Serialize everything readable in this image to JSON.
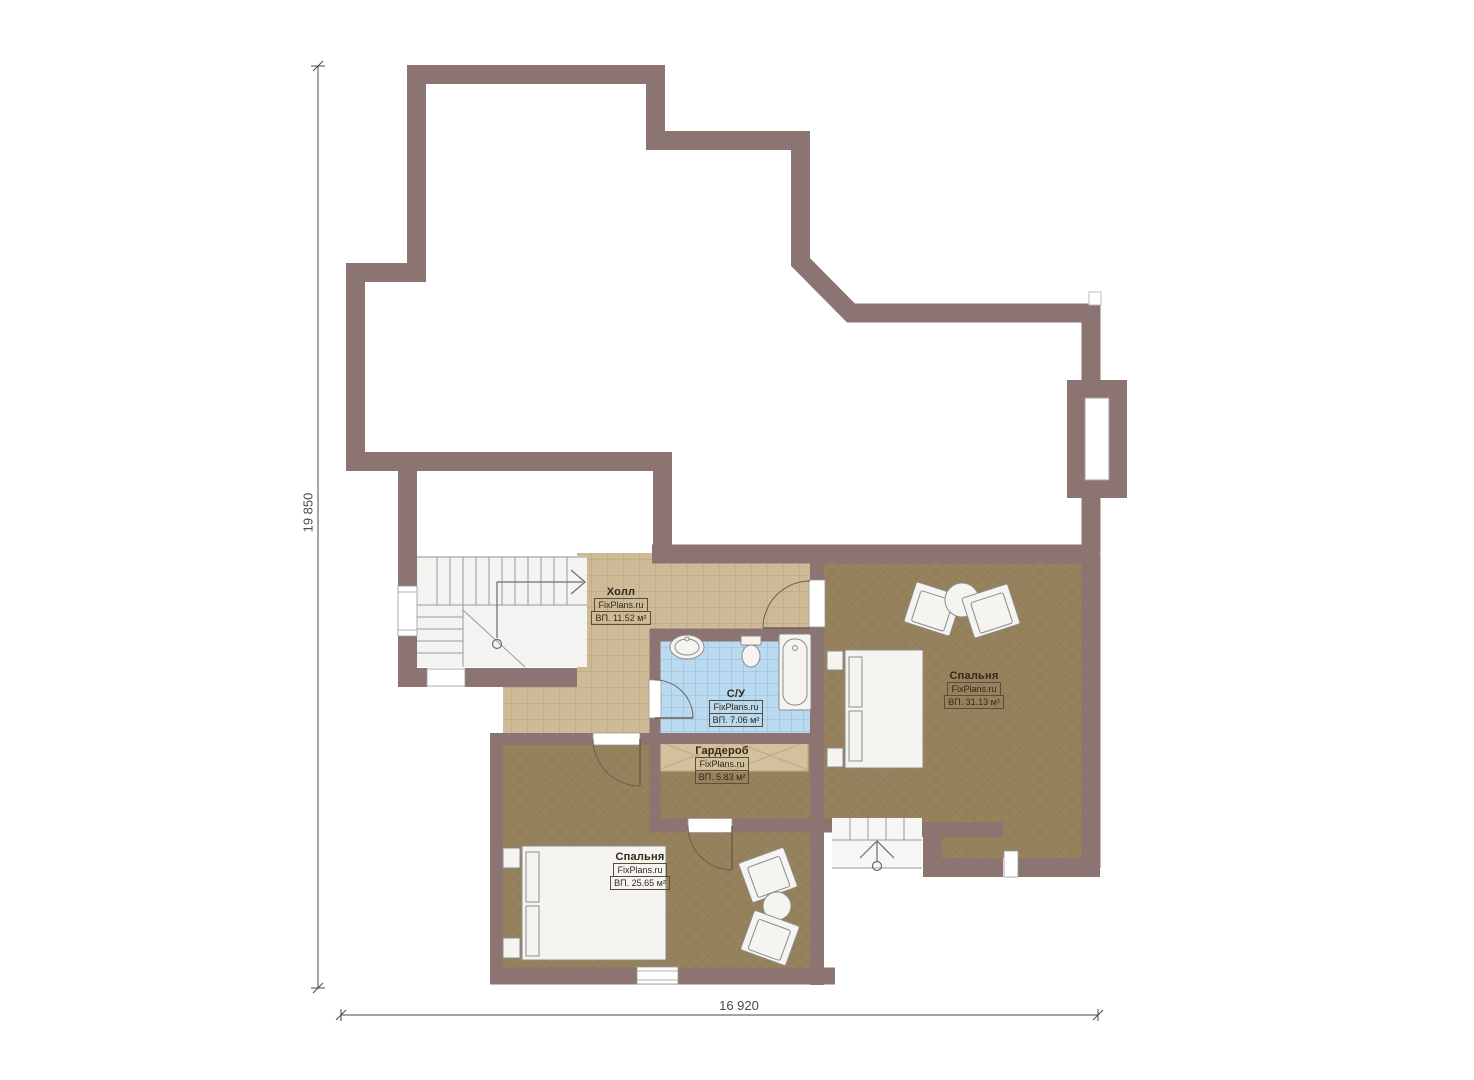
{
  "plan": {
    "title": "Floor plan (second floor)",
    "dimensions": {
      "left_total": "19 850",
      "bottom_total": "16 920"
    },
    "rooms": [
      {
        "id": "hall",
        "name": "Холл",
        "watermark": "FixPlans.ru",
        "area": "ВП. 11.52 м²"
      },
      {
        "id": "bathroom",
        "name": "С/У",
        "watermark": "FixPlans.ru",
        "area": "ВП. 7.06 м²"
      },
      {
        "id": "wardrobe",
        "name": "Гардероб",
        "watermark": "FixPlans.ru",
        "area": "ВП. 5.83 м²"
      },
      {
        "id": "bedroom-right",
        "name": "Спальня",
        "watermark": "FixPlans.ru",
        "area": "ВП. 31.13 м²"
      },
      {
        "id": "bedroom-left",
        "name": "Спальня",
        "watermark": "FixPlans.ru",
        "area": "ВП. 25.65 м²"
      }
    ],
    "colors": {
      "wall": "#8b7472",
      "hallTile": "#cdbb97",
      "hallGrid": "#b3a079",
      "bathTile": "#badaef",
      "bathGrid": "#93bcd8",
      "wardTile": "#d3c19d",
      "wardGrid": "#bcab85",
      "floorBrown": "#97825e",
      "floorLine": "#7d6a48",
      "stairBg": "#f3f3f1",
      "stairLine": "#9a9a9a",
      "furnFill": "#f5f4f1",
      "furnStroke": "#8b8b8b",
      "doorArc": "#6f5d4b",
      "dimColor": "#4a4a4a",
      "labelColor": "#33281a",
      "labelBorder": "#5d4c38"
    }
  }
}
